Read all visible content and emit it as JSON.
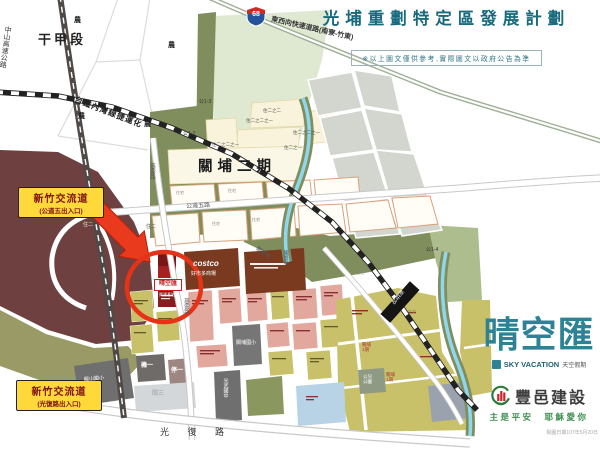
{
  "header": {
    "title": "光埔重劃特定區發展計劃",
    "disclaimer": "※以上圖文僅供參考,實際圖文以政府公告為準"
  },
  "branding": {
    "name": "晴空匯",
    "name_en": "SKY VACATION",
    "name_sub": "天空假期",
    "builder": "豐邑建設",
    "slogan": "主是平安　耶穌愛你",
    "date_note": "製圖日期107年5月20日"
  },
  "map": {
    "labels": {
      "district": "干甲段",
      "nong": "農",
      "zhongshan_hwy": "中山高速公路",
      "railway_line": "台鐵內灣線捷運化",
      "expressway": "東西向快速道路(南寮-竹東)",
      "expressway_num": "68",
      "guanpu_phase2": "關埔二期",
      "gong13": "公1-3",
      "gong12": "公1-2",
      "gong14": "公1-4",
      "zhu22": "住二之二",
      "zhu221": "住二之二之一",
      "zhu21": "住二之一",
      "zhu2": "住二",
      "zhuzhai": "住宅",
      "gongdao5_rd": "公道五路",
      "ciyun_rd": "慈雲路",
      "guandong_rd": "關東路",
      "longen_canal": "隆恩圳",
      "interchange": "新竹交流道",
      "exit_gongdao5": "(公道五出入口)",
      "exit_guangfu": "(光復路出入口)",
      "guangfu_rd": "光 復 路",
      "costco_en": "costco",
      "costco_zh": "好市多商場",
      "site_name": "晴空匯",
      "site_sub": "興建基地",
      "ji1": "機一",
      "ting1": "停一",
      "guan3": "關三",
      "school_guanpu": "關埔國小",
      "school_longshan": "龍山國小",
      "school_guangwu": "光武國中",
      "station": "新莊站",
      "guanpu_phase1": "關埔1期",
      "park_gonger": "公兒公園"
    },
    "colors": {
      "accent_red": "#e63317",
      "site_red": "#8b1c1c",
      "title_teal": "#186a7d",
      "brand_teal": "#2e8296",
      "builder_green": "#2f7d3a",
      "logo_red": "#c9252b",
      "maroon": "#6e4140",
      "khaki": "#c9c06a",
      "salmon": "#e2a89e",
      "olive": "#7f8e5c",
      "pale_green": "#dfe9d2",
      "stream_blue": "#8ed7ee",
      "badge_yellow": "#ffd83a"
    }
  }
}
